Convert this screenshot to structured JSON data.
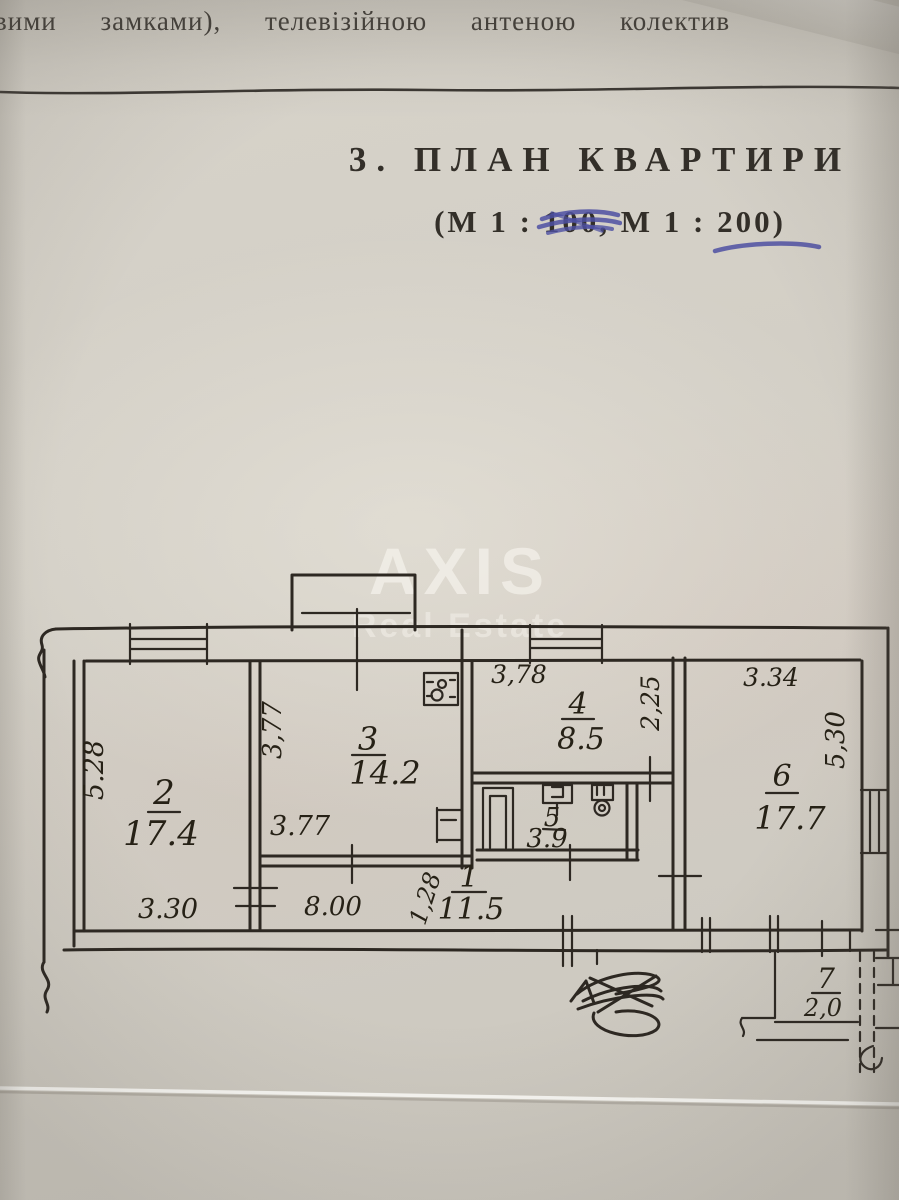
{
  "colors": {
    "ink": "#2d2822",
    "pen_blue": "#4d50a2",
    "paper": "#d3cfc6"
  },
  "header": {
    "top_line": "вими замками), телевізійною антеною колектив",
    "section_title": "3. ПЛАН КВАРТИРИ",
    "scale_prefix": "(М 1 : ",
    "scale_old": "100",
    "scale_mid": ", М 1 : ",
    "scale_new": "200",
    "scale_suffix": ")"
  },
  "watermark": {
    "brand": "AXIS",
    "sub": "Real Estate"
  },
  "plan": {
    "rooms": [
      {
        "id": "1",
        "area": "11.5"
      },
      {
        "id": "2",
        "area": "17.4"
      },
      {
        "id": "3",
        "area": "14.2"
      },
      {
        "id": "4",
        "area": "8.5"
      },
      {
        "id": "5",
        "area": "3.9"
      },
      {
        "id": "6",
        "area": "17.7"
      },
      {
        "id": "7",
        "area": "2,0"
      }
    ],
    "dims": {
      "room2_height": "5.28",
      "room2_width": "3.30",
      "room3_height": "3,77",
      "room3_width": "3.77",
      "room4_width": "3,78",
      "room4_height": "2,25",
      "room6_width": "3.34",
      "room6_height": "5,30",
      "hall_length": "8.00",
      "hall_width": "1,28"
    }
  }
}
